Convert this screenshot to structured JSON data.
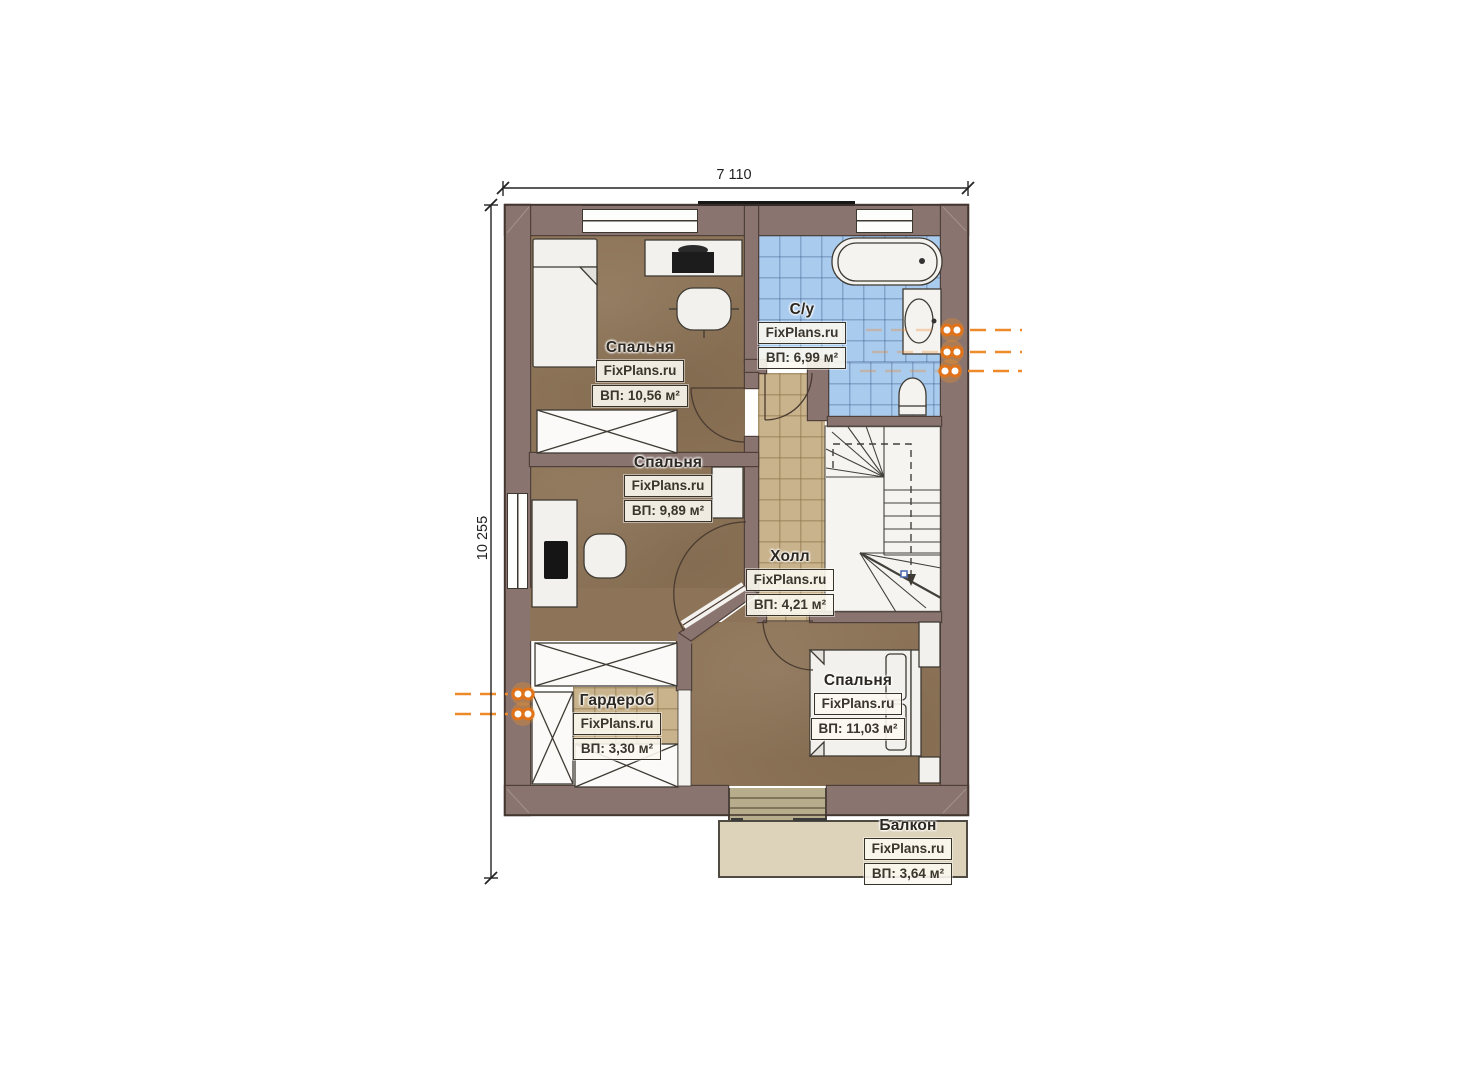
{
  "watermark": "FixPlans.ru",
  "dimensions": {
    "width_label": "7 110",
    "height_label": "10 255"
  },
  "rooms": [
    {
      "key": "bedroom-1",
      "name": "Спальня",
      "area": "ВП: 10,56 м²"
    },
    {
      "key": "bathroom",
      "name": "С/у",
      "area": "ВП: 6,99 м²"
    },
    {
      "key": "bedroom-2",
      "name": "Спальня",
      "area": "ВП: 9,89 м²"
    },
    {
      "key": "hall",
      "name": "Холл",
      "area": "ВП: 4,21 м²"
    },
    {
      "key": "wardrobe",
      "name": "Гардероб",
      "area": "ВП: 3,30 м²"
    },
    {
      "key": "bedroom-3",
      "name": "Спальня",
      "area": "ВП: 11,03 м²"
    },
    {
      "key": "balcony",
      "name": "Балкон",
      "area": "ВП: 3,64 м²"
    }
  ],
  "icons": {
    "riser_marker": "pipe-riser",
    "stairs": "staircase"
  },
  "colors": {
    "wall": "#8a7470",
    "floor_wood": "#8d7458",
    "tile_blue": "#a9cbee",
    "tile_beige": "#c9b38c",
    "balcony_floor": "#ddd2ba",
    "accent_orange": "#e8761e",
    "line_dark": "#3f3a33"
  }
}
